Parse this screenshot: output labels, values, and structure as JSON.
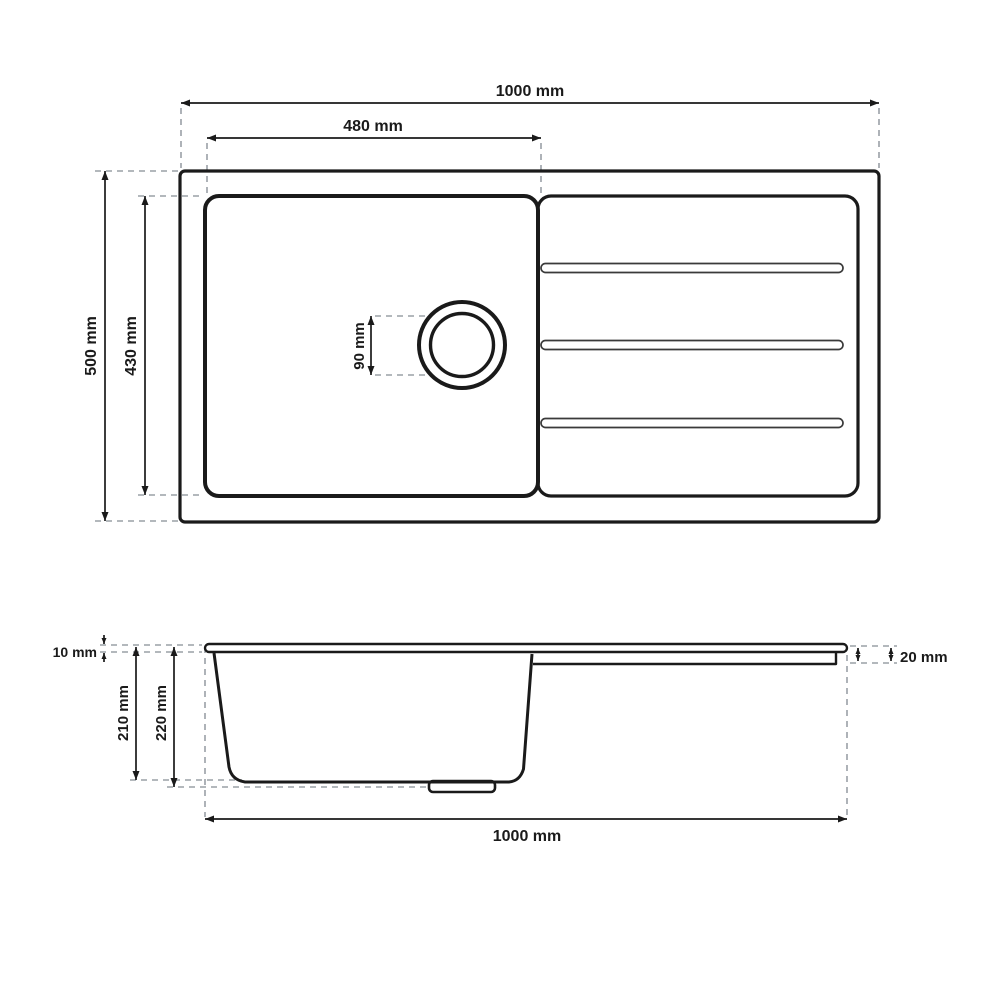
{
  "drawing": {
    "subject": "inset kitchen sink with drainboard, dimensioned technical drawing",
    "views": [
      "top view",
      "side profile view"
    ]
  },
  "top_view": {
    "overall_width_label": "1000 mm",
    "bowl_width_label": "480 mm",
    "overall_depth_label": "500 mm",
    "bowl_depth_label": "430 mm",
    "drain_diameter_label": "90 mm",
    "drainboard_groove_count": 3
  },
  "side_view": {
    "rim_thickness_label": "10 mm",
    "bowl_inner_depth_label": "210 mm",
    "bowl_overall_depth_label": "220 mm",
    "drainboard_thickness_label": "20 mm",
    "overall_length_label": "1000 mm"
  },
  "colors": {
    "line": "#1a1a1a",
    "dashed_line": "#9aa0a6",
    "background": "#ffffff"
  }
}
